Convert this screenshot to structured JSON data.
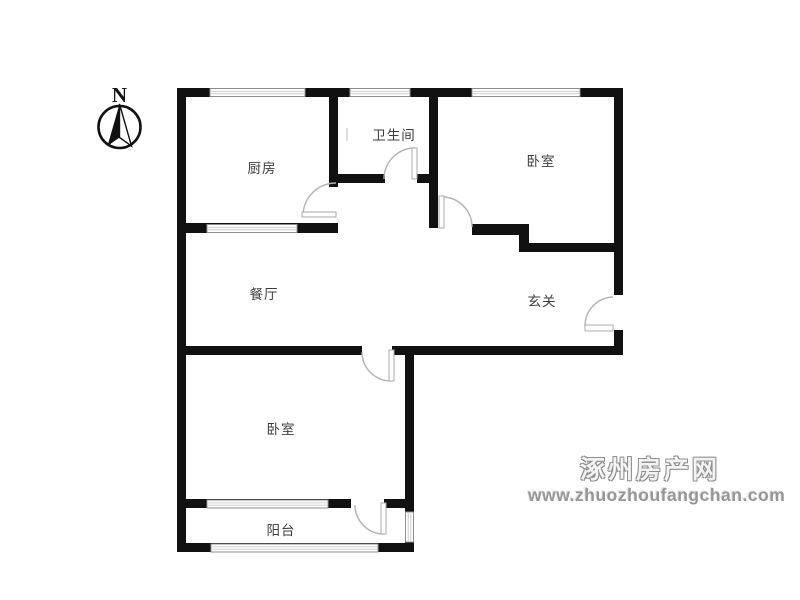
{
  "compass": {
    "north_label": "N"
  },
  "rooms": {
    "kitchen": {
      "label": "厨房"
    },
    "bathroom": {
      "label": "卫生间"
    },
    "bedroom_top": {
      "label": "卧室"
    },
    "dining": {
      "label": "餐厅"
    },
    "entry": {
      "label": "玄关"
    },
    "bedroom_bottom": {
      "label": "卧室"
    },
    "balcony": {
      "label": "阳台"
    }
  },
  "watermark": {
    "site_name": "涿州房产网",
    "site_url": "www.zhuozhoufangchan.com"
  },
  "colors": {
    "wall": "#111111",
    "window_line": "#8e8e8e",
    "window_inner_line": "#c9c9c9",
    "door_arc": "#b3b3b3",
    "label_text": "#3d3d3d",
    "watermark_gray": "#8f8f8f",
    "background": "#ffffff"
  }
}
